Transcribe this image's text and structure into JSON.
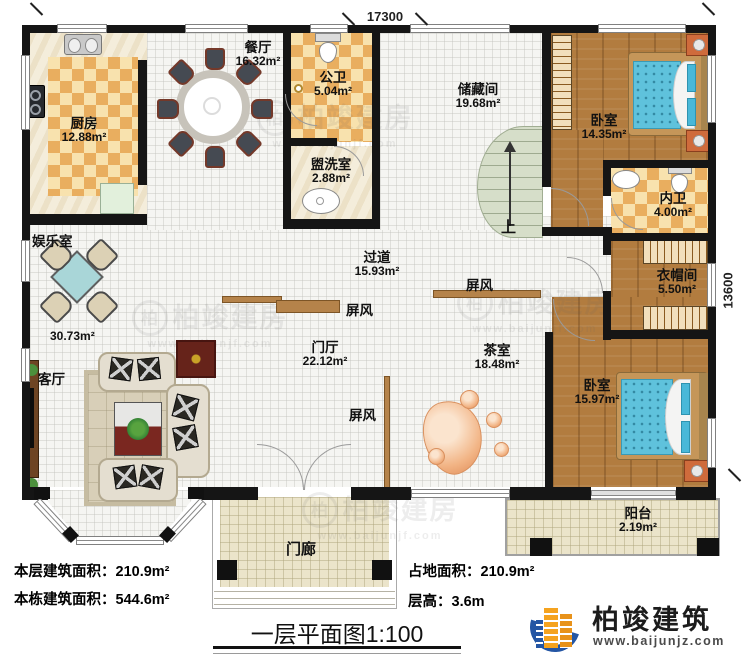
{
  "meta": {
    "title": "一层平面图1:100"
  },
  "dims": {
    "top": "17300",
    "right": "13600"
  },
  "rooms": {
    "kitchen": {
      "name": "厨房",
      "area": "12.88m²"
    },
    "dining": {
      "name": "餐厅",
      "area": "16.32m²"
    },
    "public_bath": {
      "name": "公卫",
      "area": "5.04m²"
    },
    "washroom": {
      "name": "盥洗室",
      "area": "2.88m²"
    },
    "storage": {
      "name": "储藏间",
      "area": "19.68m²"
    },
    "bedroom1": {
      "name": "卧室",
      "area": "14.35m²"
    },
    "inner_bath": {
      "name": "内卫",
      "area": "4.00m²"
    },
    "cloakroom": {
      "name": "衣帽间",
      "area": "5.50m²"
    },
    "corridor": {
      "name": "过道",
      "area": "15.93m²"
    },
    "entertainment": {
      "name": "娱乐室",
      "area": "30.73m²"
    },
    "living": {
      "name": "客厅"
    },
    "foyer": {
      "name": "门厅",
      "area": "22.12m²"
    },
    "tea": {
      "name": "茶室",
      "area": "18.48m²"
    },
    "bedroom2": {
      "name": "卧室",
      "area": "15.97m²"
    },
    "balcony": {
      "name": "阳台",
      "area": "2.19m²"
    },
    "porch": {
      "name": "门廊"
    }
  },
  "labels": {
    "screen": "屏风",
    "up": "上"
  },
  "stats": {
    "floor_area_label": "本层建筑面积：",
    "floor_area": "210.9m²",
    "building_area_label": "本栋建筑面积：",
    "building_area": "544.6m²",
    "land_area_label": "占地面积：",
    "land_area": "210.9m²",
    "storey_height_label": "层高：",
    "storey_height": "3.6m"
  },
  "brand": {
    "name": "柏竣建筑",
    "url": "www.baijunjz.com"
  },
  "watermark": {
    "text": "柏竣建房",
    "url": "www.baijunjf.com",
    "initial": "柏"
  },
  "colors": {
    "wall": "#151515",
    "wood_floor": "#b27c3f",
    "checker_orange": "#e9ae5f",
    "checker_cream": "#f8e2ae",
    "bed_blue": "#5fc2dc",
    "screen_brown": "#b5834a",
    "stair_green": "#d6dec9",
    "outdoor_tile": "#ebe4ca",
    "logo_blue": "#2456a4",
    "logo_orange": "#f5a31f"
  }
}
